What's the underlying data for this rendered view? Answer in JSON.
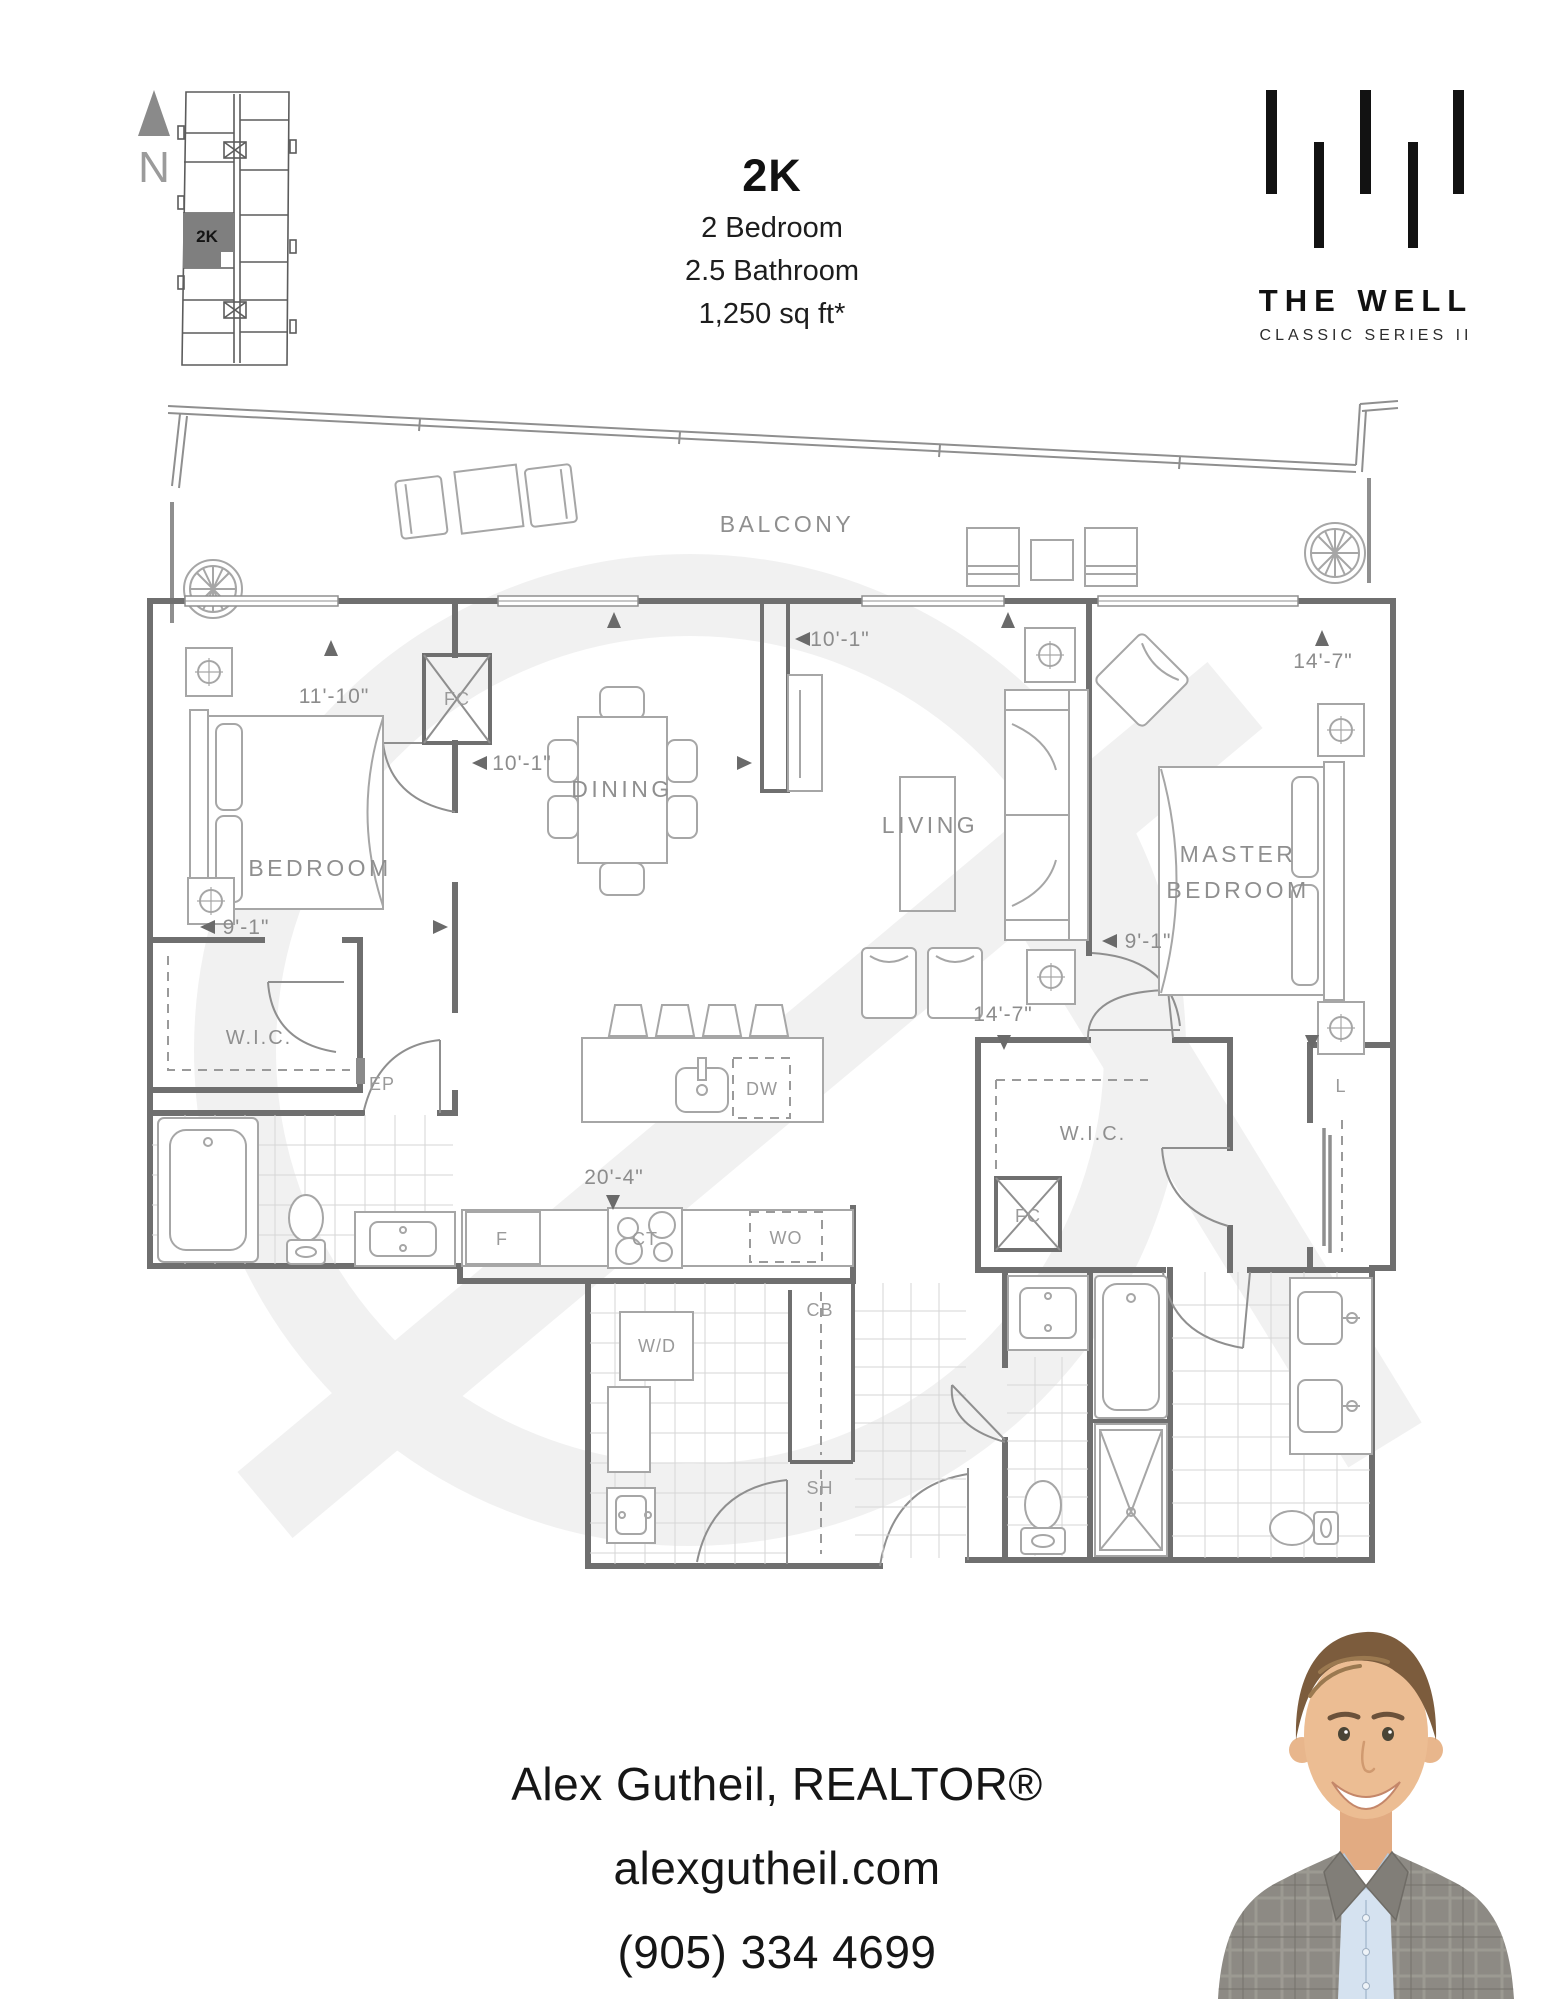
{
  "header": {
    "unit": "2K",
    "spec1": "2 Bedroom",
    "spec2": "2.5 Bathroom",
    "spec3": "1,250 sq ft*"
  },
  "keyplan": {
    "north": "N",
    "unit": "2K"
  },
  "brand": {
    "name": "THE WELL",
    "series": "CLASSIC SERIES II"
  },
  "floorplan": {
    "rooms": {
      "balcony": "BALCONY",
      "bedroom": "BEDROOM",
      "dining": "DINING",
      "living": "LIVING",
      "master1": "MASTER",
      "master2": "BEDROOM",
      "wic_bedroom": "W.I.C.",
      "wic_master": "W.I.C."
    },
    "fixtures": {
      "fc_top": "FC",
      "fc_master": "FC",
      "ep": "EP",
      "linen": "L",
      "fridge": "F",
      "cooktop": "CT",
      "wall_oven": "WO",
      "dishwasher": "DW",
      "cabinet": "CB",
      "washer_dryer": "W/D",
      "shelf": "SH"
    },
    "dims": {
      "bedroom_w": "11'-10\"",
      "dining_w": "10'-1\"",
      "living_w": "10'-1\"",
      "master_w": "14'-7\"",
      "bedroom_d": "9'-1\"",
      "master_d": "9'-1\"",
      "hall": "14'-7\"",
      "kitchen": "20'-4\""
    }
  },
  "contact": {
    "name": "Alex Gutheil, REALTOR®",
    "website": "alexgutheil.com",
    "phone": "(905) 334 4699"
  }
}
